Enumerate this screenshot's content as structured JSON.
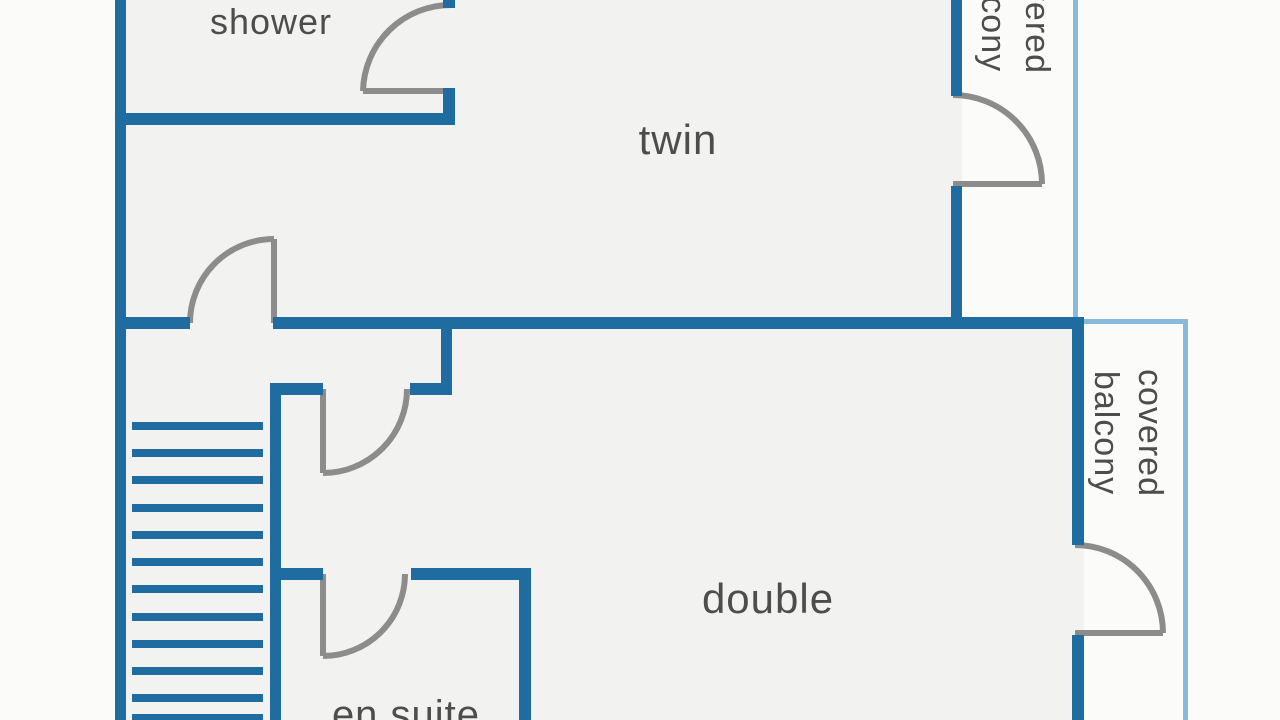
{
  "page": {
    "title": "apartment floor plan"
  },
  "rooms": {
    "shower": "shower",
    "twin": "twin",
    "double": "double",
    "en_suite": "en suite",
    "balcony_top": {
      "line1": "covered",
      "line2": "balcony"
    },
    "balcony_right": {
      "line1": "covered",
      "line2": "balcony"
    }
  },
  "colors": {
    "wall": "#1f6da0",
    "balcony_outline": "#88badb",
    "door": "#8c8c8c",
    "text": "#4d4d4d",
    "floor": "#f2f2f0",
    "background": "#fbfbf9"
  },
  "stairs": {
    "tread_count": 12
  }
}
